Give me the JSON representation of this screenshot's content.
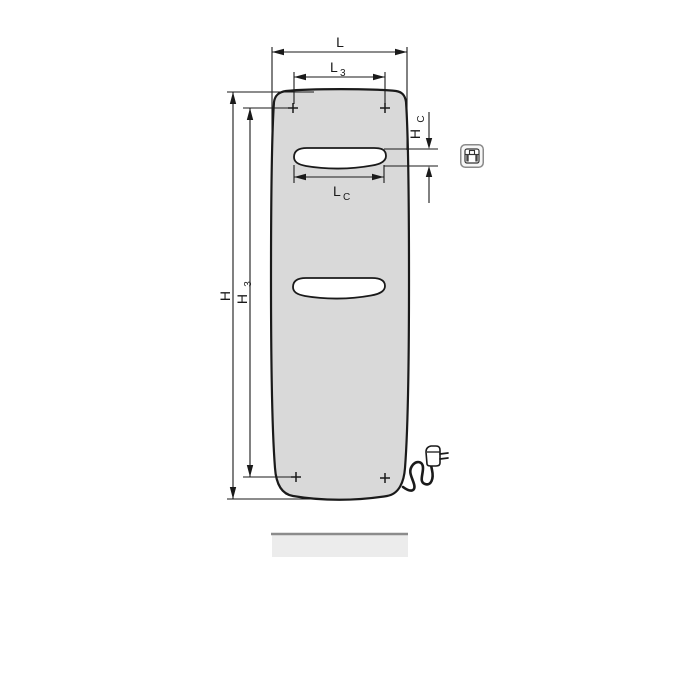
{
  "diagram": {
    "kind": "technical dimension drawing of a flat panel radiator (front view) with electric cable and plug",
    "labels": {
      "L": {
        "main": "L"
      },
      "L3": {
        "main": "L",
        "sub": "3"
      },
      "LC": {
        "main": "L",
        "sub": "C"
      },
      "H": {
        "main": "H"
      },
      "H3": {
        "main": "H",
        "sub": "3"
      },
      "HC": {
        "main": "H",
        "sub": "C"
      }
    },
    "icons": {
      "electric_connection": "electric-connection-badge"
    },
    "colors": {
      "panel_fill": "#d9d9d9",
      "slot_fill": "#ffffff",
      "line": "#1a1a1a",
      "baseboard_fill": "#ececec",
      "baseboard_edge": "#8c8c8c",
      "icon_border": "#8a8a8a"
    }
  }
}
